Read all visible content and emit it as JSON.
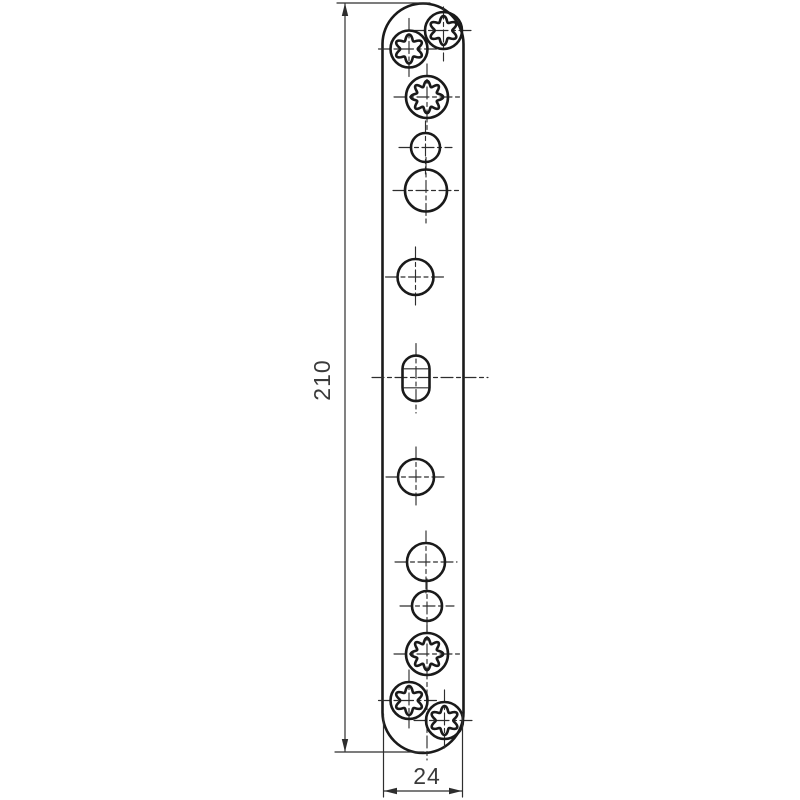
{
  "drawing": {
    "type": "technical-drawing",
    "subject": "bone-plate-with-screw-holes",
    "colors": {
      "background": "#ffffff",
      "outline": "#1a1a1a",
      "centerline": "#2e2e2e",
      "dimension": "#2e2e2e",
      "text": "#3a3a3a"
    },
    "plate": {
      "left": 382.5,
      "right": 463.5,
      "side_top_y": 44,
      "side_bottom_y": 712.5
    },
    "holes": [
      {
        "type": "torx6",
        "cx": 409,
        "cy": 49,
        "r": 18.5
      },
      {
        "type": "torx6",
        "cx": 443.5,
        "cy": 30.5,
        "r": 18.5,
        "vext": [
          7,
          61
        ]
      },
      {
        "type": "star8",
        "cx": 427,
        "cy": 97,
        "r": 21
      },
      {
        "type": "circle",
        "cx": 425.5,
        "cy": 147.5,
        "r": 14.5
      },
      {
        "type": "circle",
        "cx": 426,
        "cy": 190.5,
        "r": 21
      },
      {
        "type": "circle",
        "cx": 415.5,
        "cy": 277,
        "r": 18
      },
      {
        "type": "slot",
        "cx": 416,
        "cy": 378.3,
        "w": 27,
        "h": 45.5
      },
      {
        "type": "circle",
        "cx": 416,
        "cy": 477,
        "r": 18
      },
      {
        "type": "circle",
        "cx": 426,
        "cy": 562,
        "r": 19
      },
      {
        "type": "circle",
        "cx": 427,
        "cy": 606,
        "r": 15
      },
      {
        "type": "star8",
        "cx": 427,
        "cy": 654,
        "r": 21,
        "vext": [
          621,
          760
        ]
      },
      {
        "type": "torx6",
        "cx": 409,
        "cy": 700.5,
        "r": 18.5
      },
      {
        "type": "torx6",
        "cx": 444.5,
        "cy": 720.5,
        "r": 18.5
      }
    ],
    "star_profiles": {
      "torx6": {
        "k": 6,
        "mid": 11.65,
        "amp": 2.85
      },
      "star8": {
        "k": 8,
        "mid": 13.4,
        "amp": 2.8
      }
    },
    "slot_centerline": {
      "y": 377.5,
      "x1": 372,
      "x2": 488
    },
    "dimensions": {
      "length": {
        "value": "210",
        "line_x": 345,
        "line_y1": 4,
        "line_y2": 751,
        "ext_top": {
          "y": 3,
          "x1": 337,
          "x2": 430
        },
        "ext_bottom": {
          "y": 752,
          "x1": 335,
          "x2": 424
        },
        "label_x": 330,
        "label_y": 380
      },
      "width": {
        "value": "24",
        "line_y": 791,
        "x1": 384,
        "x2": 462,
        "ext_left_x": 383.5,
        "ext_right_x": 462.5,
        "ext_y1": 714,
        "ext_y2": 797,
        "label_x": 427,
        "label_y": 784
      }
    }
  }
}
